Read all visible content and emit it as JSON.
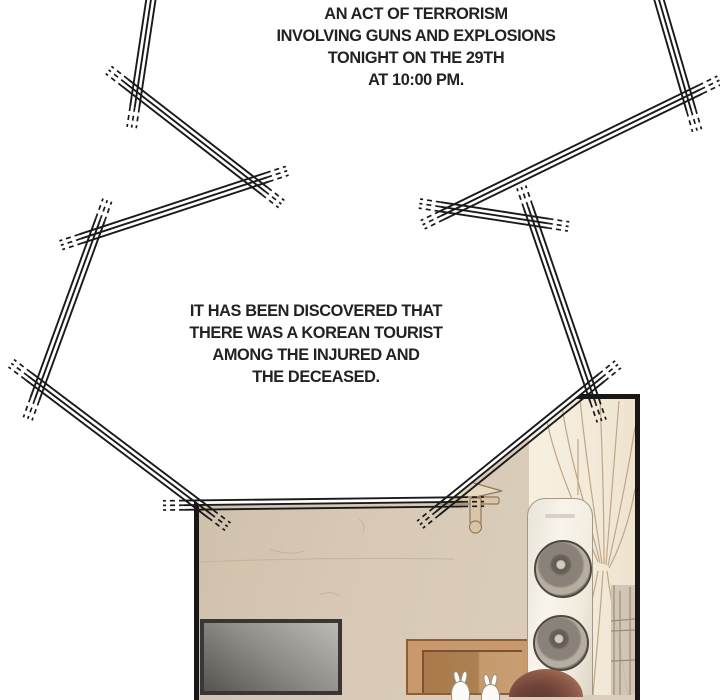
{
  "broadcast_bubble": {
    "text_blocks": [
      {
        "lines": [
          "AN ACT OF TERRORISM",
          "INVOLVING GUNS AND EXPLOSIONS",
          "TONIGHT ON THE 29TH",
          "AT 10:00 PM."
        ]
      },
      {
        "lines": [
          "IT HAS BEEN DISCOVERED THAT",
          "THERE WAS A KOREAN TOURIST",
          "AMONG THE INJURED AND",
          "THE DECEASED."
        ]
      }
    ]
  },
  "colors": {
    "ink": "#1a1a1a",
    "text": "#222222",
    "background": "#ffffff",
    "wall": "#d6c8b4",
    "wood": "#c9996b",
    "curtain": "#f3ead9",
    "curtain_fold": "#bfa688",
    "hair": "#7d4e40",
    "screen_dark": "#575350",
    "speaker_body": "#f5f0e6"
  }
}
